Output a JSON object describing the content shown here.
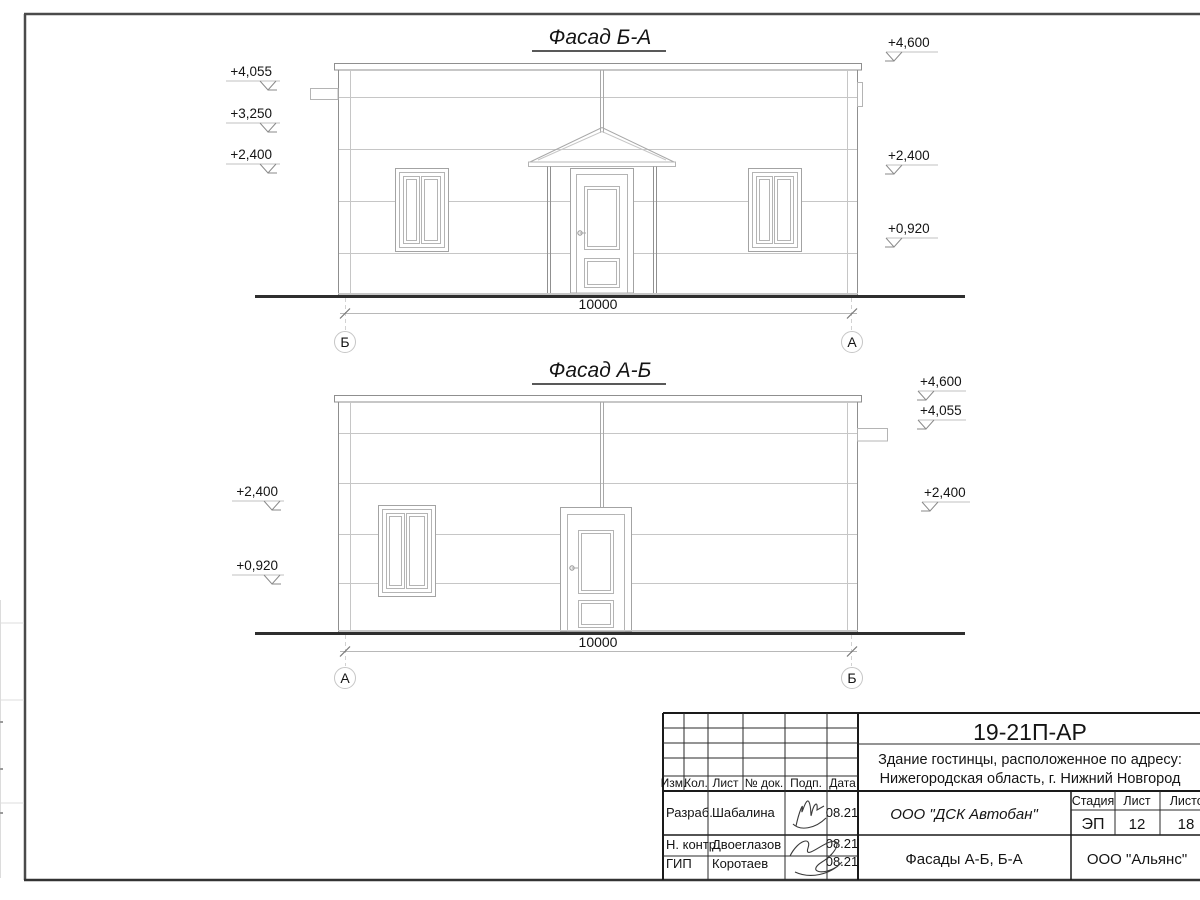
{
  "facades": [
    {
      "title": "Фасад Б-А",
      "marks_left": [
        "+4,055",
        "+3,250",
        "+2,400"
      ],
      "marks_right": [
        "+4,600",
        "+2,400",
        "+0,920"
      ],
      "dimension": "10000",
      "axis_left": "Б",
      "axis_right": "А"
    },
    {
      "title": "Фасад А-Б",
      "marks_left": [
        "+2,400",
        "+0,920"
      ],
      "marks_right": [
        "+4,600",
        "+4,055",
        "+2,400"
      ],
      "dimension": "10000",
      "axis_left": "А",
      "axis_right": "Б"
    }
  ],
  "title_block": {
    "code": "19-21П-АР",
    "address1": "Здание гостинцы, расположенное по адресу:",
    "address2": "Нижегородская область, г. Нижний Новгород",
    "col_izm": "Изм.",
    "col_kol": "Кол.",
    "col_list": "Лист",
    "col_ndok": "№ док.",
    "col_podp": "Подп.",
    "col_data": "Дата",
    "rows": [
      {
        "role": "Разраб.",
        "name": "Шабалина",
        "date": "08.21"
      },
      {
        "role": "Н. контр.",
        "name": "Двоеглазов",
        "date": "08.21"
      },
      {
        "role": "ГИП",
        "name": "Коротаев",
        "date": "08.21"
      }
    ],
    "org_contractor": "ООО \"ДСК Автобан\"",
    "sheet_title": "Фасады А-Б, Б-А",
    "org_client": "ООО \"Альянс\"",
    "stage_label": "Стадия",
    "sheet_label": "Лист",
    "sheets_label": "Листов",
    "stage_value": "ЭП",
    "sheet_value": "12",
    "sheets_value": "18"
  },
  "colors": {
    "paper": "#ffffff",
    "line_building": "#909090",
    "line_panel": "#c6c6c6",
    "ground": "#2e2e2e",
    "title_block_line": "#1a1a1a",
    "text": "#141414"
  }
}
